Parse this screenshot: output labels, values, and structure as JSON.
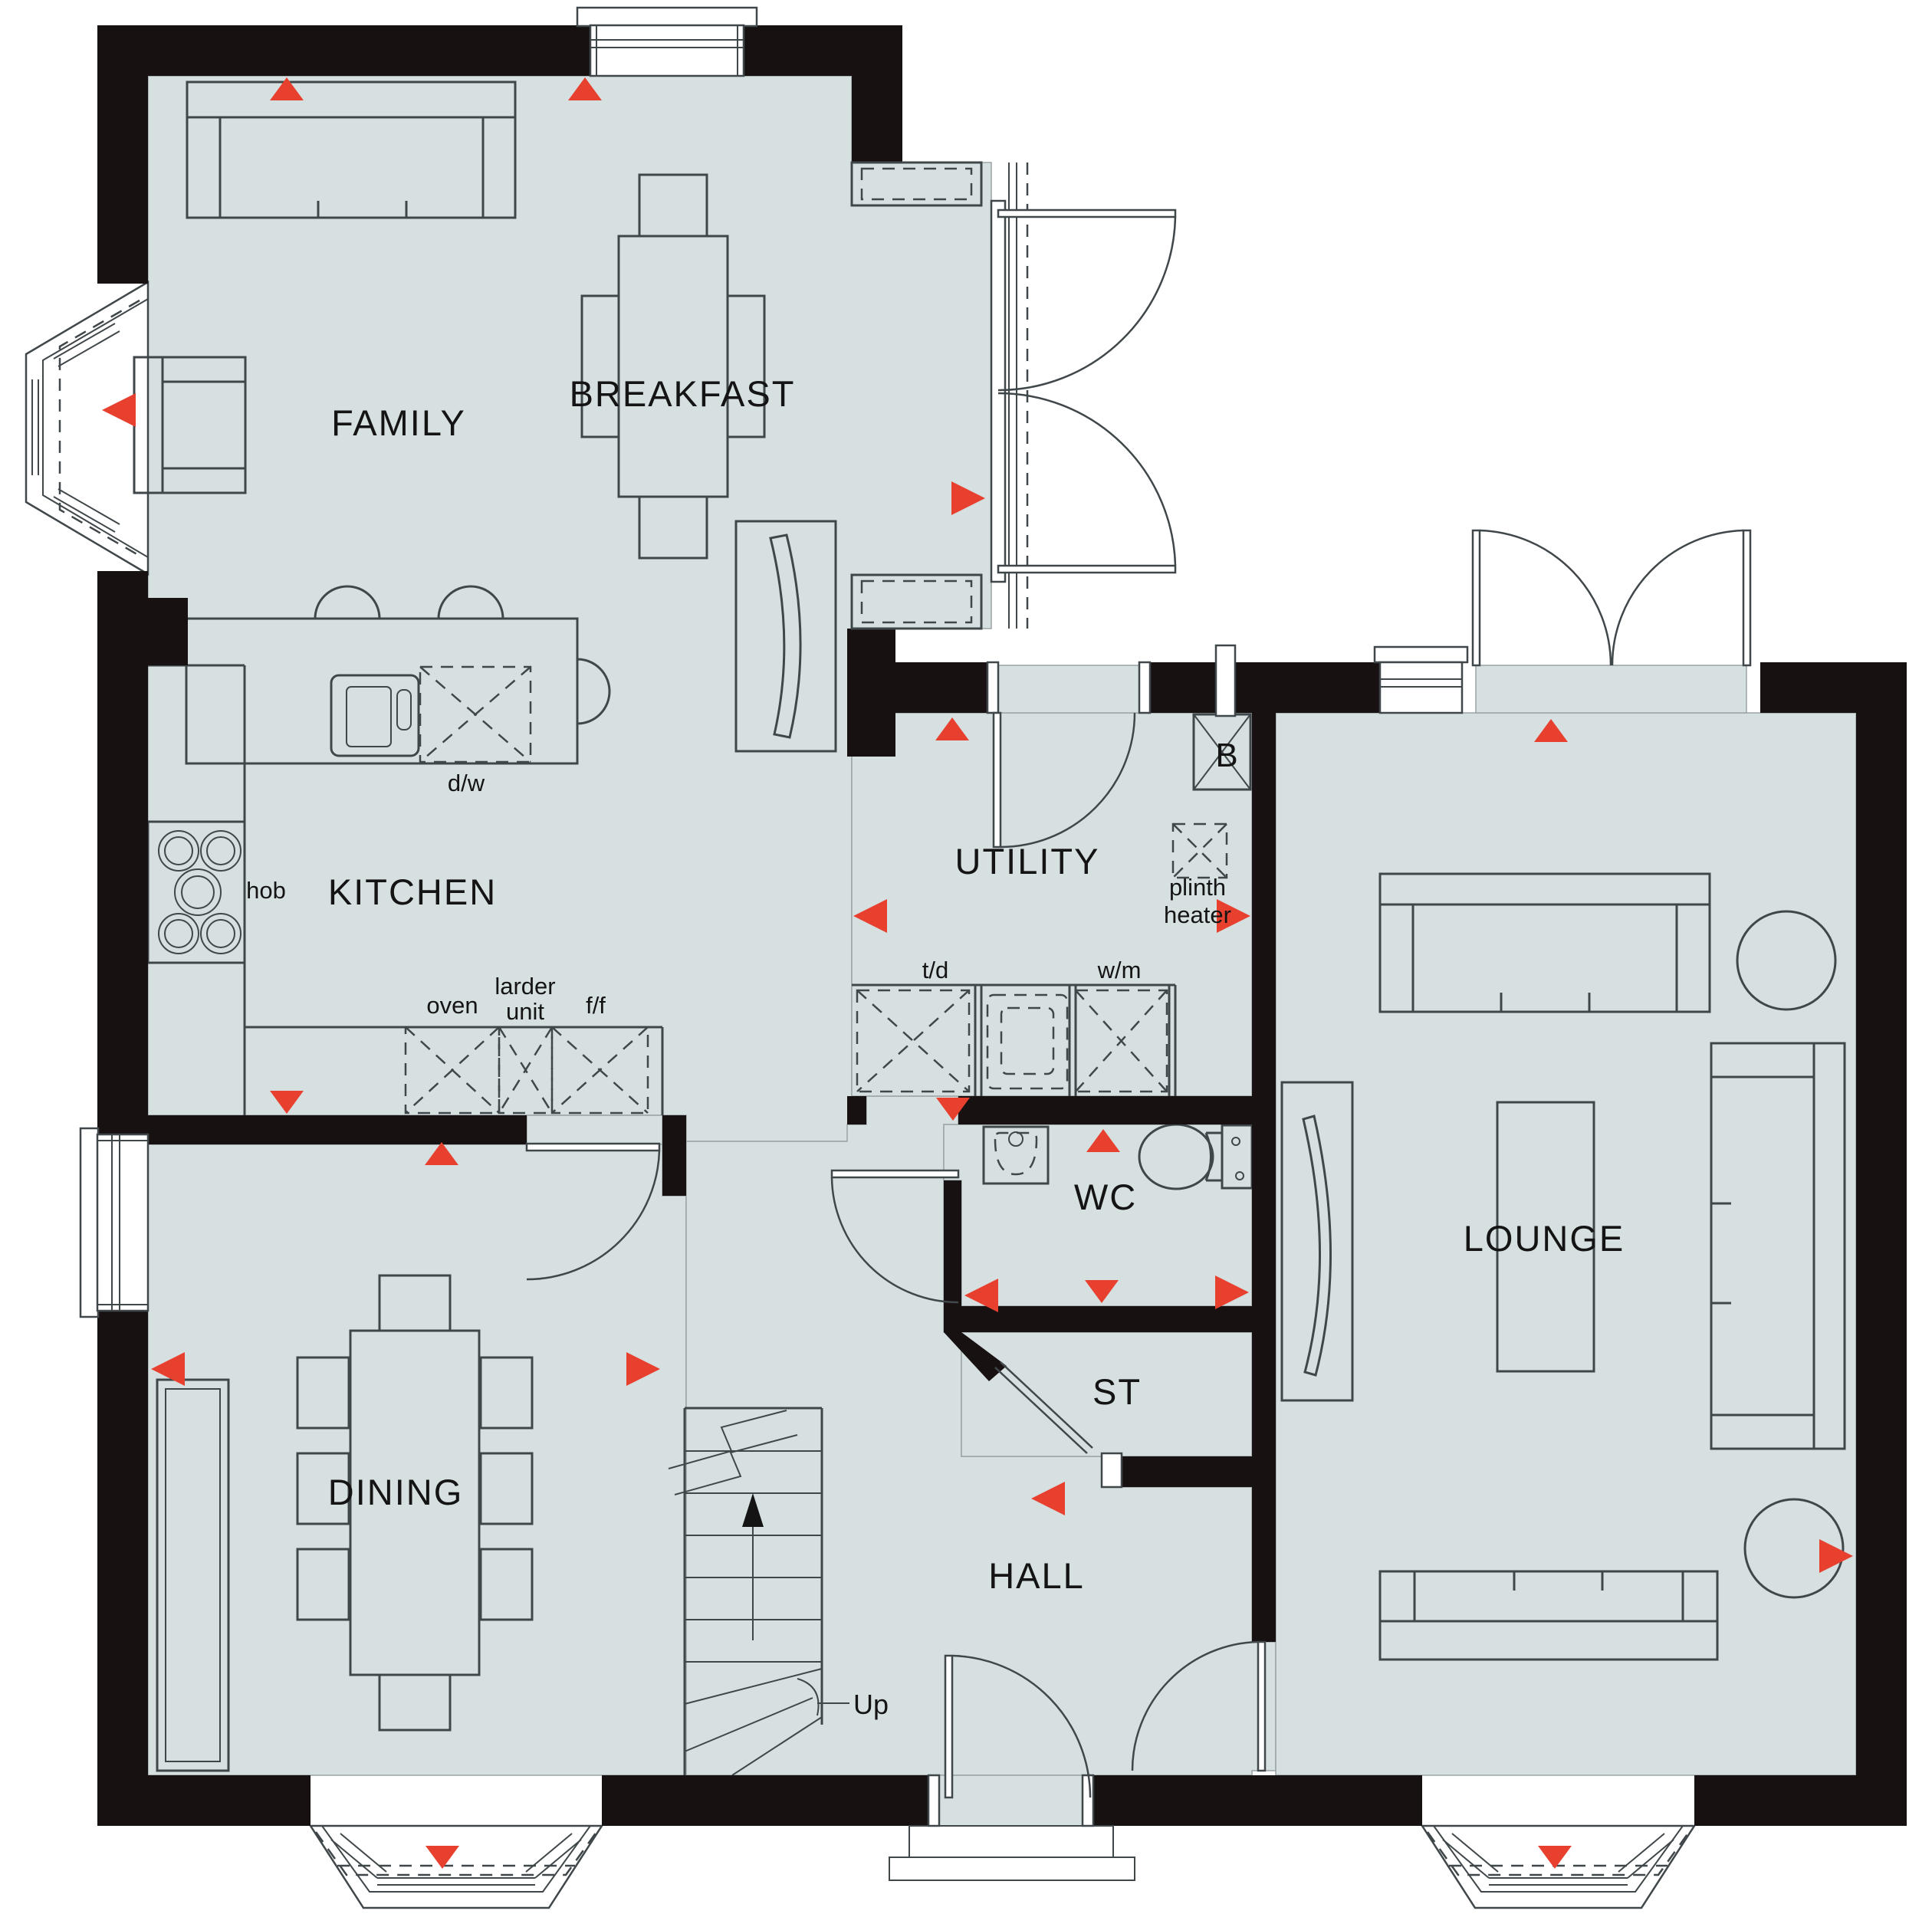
{
  "plan": {
    "rooms": {
      "family": {
        "label": "FAMILY"
      },
      "breakfast": {
        "label": "BREAKFAST"
      },
      "kitchen": {
        "label": "KITCHEN"
      },
      "dining": {
        "label": "DINING"
      },
      "lounge": {
        "label": "LOUNGE"
      },
      "utility": {
        "label": "UTILITY"
      },
      "wc": {
        "label": "WC"
      },
      "store": {
        "label": "ST"
      },
      "hall": {
        "label": "HALL"
      }
    },
    "fixtures": {
      "hob": "hob",
      "dishwasher": "d/w",
      "oven": "oven",
      "larder_line1": "larder",
      "larder_line2": "unit",
      "fridge_freezer": "f/f",
      "tumble_dryer": "t/d",
      "washing_machine": "w/m",
      "plinth_line1": "plinth",
      "plinth_line2": "heater",
      "boiler": "B",
      "stairs_direction": "Up"
    },
    "colors": {
      "floor": "#d7e0e1",
      "wall": "#171112",
      "marker": "#e8402f",
      "line": "#40474a"
    }
  }
}
